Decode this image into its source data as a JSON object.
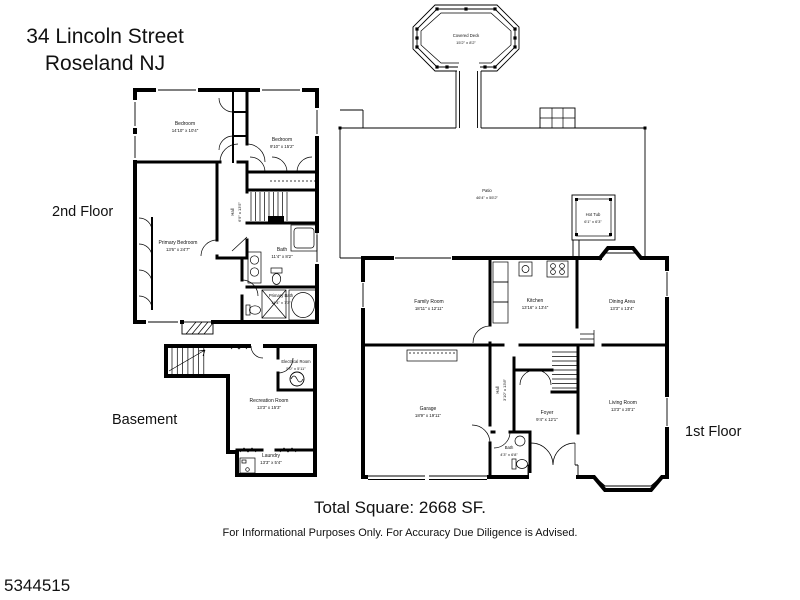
{
  "title": {
    "line1": "34 Lincoln Street",
    "line2": "Roseland NJ"
  },
  "floor_labels": {
    "second": "2nd Floor",
    "basement": "Basement",
    "first": "1st Floor"
  },
  "outdoor": {
    "deck": {
      "name": "Covered Deck",
      "dims": "15'2\" x 8'2\""
    },
    "patio": {
      "name": "Patio",
      "dims": "46'4\" x 55'2\""
    },
    "hot_tub": {
      "name": "Hot Tub",
      "dims": "6'1\" x 6'3\""
    }
  },
  "second_floor": {
    "bedroom_left": {
      "name": "Bedroom",
      "dims": "14'10\" x 10'4\""
    },
    "bedroom_right": {
      "name": "Bedroom",
      "dims": "9'10\" x 15'2\""
    },
    "primary_bedroom": {
      "name": "Primary Bedroom",
      "dims": "13'6\" x 24'7\""
    },
    "hall": {
      "name": "Hall",
      "dims": "6'9\" x 13'5\""
    },
    "bath": {
      "name": "Bath",
      "dims": "11'4\" x 8'2\""
    },
    "primary_bath": {
      "name": "Primary Bath",
      "dims": "11'4\" x 7'3\""
    }
  },
  "basement": {
    "recreation_room": {
      "name": "Recreation Room",
      "dims": "13'3\" x 15'3\""
    },
    "electrical_room": {
      "name": "Electrical Room",
      "dims": "5'0\" x 5'11\""
    },
    "laundry": {
      "name": "Laundry",
      "dims": "13'3\" x 5'4\""
    }
  },
  "first_floor": {
    "family_room": {
      "name": "Family Room",
      "dims": "18'11\" x 12'11\""
    },
    "kitchen": {
      "name": "Kitchen",
      "dims": "13'16\" x 13'4\""
    },
    "dining_area": {
      "name": "Dining Area",
      "dims": "13'3\" x 13'4\""
    },
    "garage": {
      "name": "Garage",
      "dims": "18'9\" x 19'11\""
    },
    "hall": {
      "name": "Hall",
      "dims": "3'10\" x 13'8\""
    },
    "foyer": {
      "name": "Foyer",
      "dims": "9'4\" x 12'1\""
    },
    "bath": {
      "name": "Bath",
      "dims": "4'3\" x 6'8\""
    },
    "living_room": {
      "name": "Living Room",
      "dims": "13'3\" x 20'1\""
    }
  },
  "footer": {
    "total_square": "Total Square:  2668 SF.",
    "disclaimer": "For Informational Purposes Only.  For Accuracy Due Diligence is Advised."
  },
  "watermark": "5344515",
  "colors": {
    "line": "#000000",
    "background": "#ffffff"
  }
}
